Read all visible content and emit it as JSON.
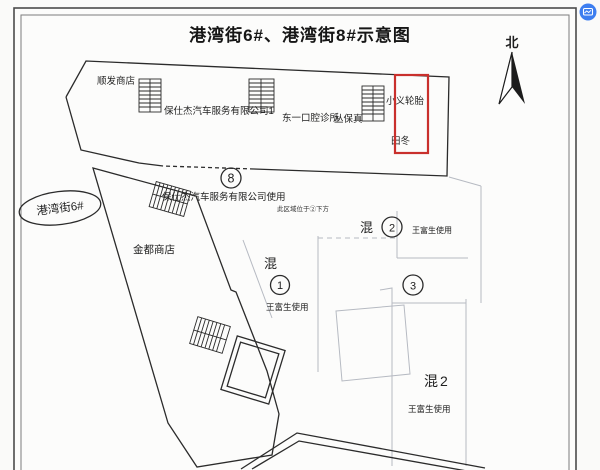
{
  "page": {
    "title": "港湾街6#、港湾街8#示意图",
    "compass": {
      "label": "北"
    },
    "street": {
      "label": "港湾街6#"
    },
    "top_row": {
      "shop1": "顺发商店",
      "shop2": "保仕杰汽车服务有限公司1",
      "shop3": "东一口腔诊所",
      "shop4": "丛保真",
      "shop5": "小义轮胎",
      "shop6": "田冬"
    },
    "middle": {
      "badge": "8",
      "usage": "保仕杰汽车服务有限公司使用",
      "note": "此区域位于②下方",
      "store": "金都商店"
    },
    "units": {
      "unit1": {
        "type": "混",
        "badge": "1",
        "user": "王富生使用"
      },
      "unit2": {
        "type": "混",
        "badge": "2",
        "user": "王富生使用"
      },
      "unit3": {
        "badge": "3"
      },
      "unit4": {
        "type": "混2",
        "user": "王富生使用"
      }
    },
    "colors": {
      "highlight_red": "#c9302c",
      "ink": "#2b2b2b",
      "faint_line": "#b6bac2",
      "paper": "#fbfbfa",
      "overlay_icon_blue": "#3d7ef0"
    }
  }
}
